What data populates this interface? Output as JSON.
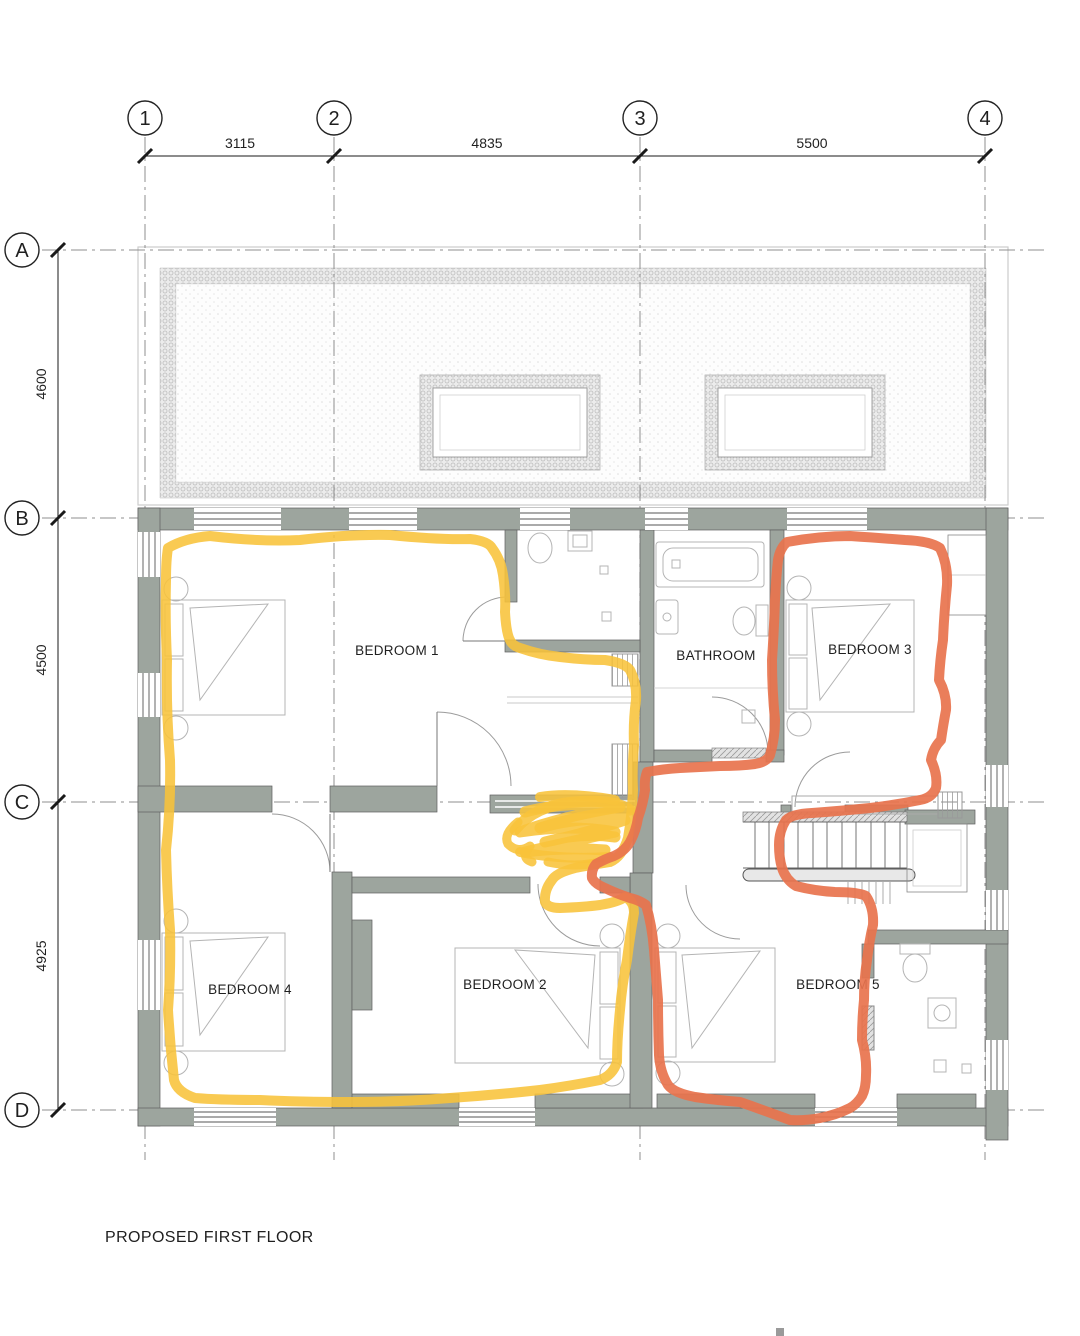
{
  "title": "PROPOSED FIRST FLOOR",
  "grid": {
    "columns": [
      {
        "label": "1"
      },
      {
        "label": "2"
      },
      {
        "label": "3"
      },
      {
        "label": "4"
      }
    ],
    "rows": [
      {
        "label": "A"
      },
      {
        "label": "B"
      },
      {
        "label": "C"
      },
      {
        "label": "D"
      }
    ],
    "column_dims": [
      "3115",
      "4835",
      "5500"
    ],
    "row_dims": [
      "4600",
      "4500",
      "4925"
    ]
  },
  "rooms": [
    {
      "label": "BEDROOM 1"
    },
    {
      "label": "BATHROOM"
    },
    {
      "label": "BEDROOM 3"
    },
    {
      "label": "BEDROOM 4"
    },
    {
      "label": "BEDROOM 2"
    },
    {
      "label": "BEDROOM 5"
    }
  ],
  "annotations": {
    "yellow_marker": {
      "color": "#F8C33A",
      "shape": "freehand loop around BEDROOM 1, BEDROOM 4, BEDROOM 2 with scribble over hallway"
    },
    "orange_marker": {
      "color": "#E8734D",
      "shape": "freehand loop around BEDROOM 3, stairs and BEDROOM 5"
    }
  },
  "colors": {
    "wall": "#9da59e",
    "line": "#1a1a1a",
    "grid_line": "#8f8f8f",
    "furniture": "#b4b4b4"
  }
}
